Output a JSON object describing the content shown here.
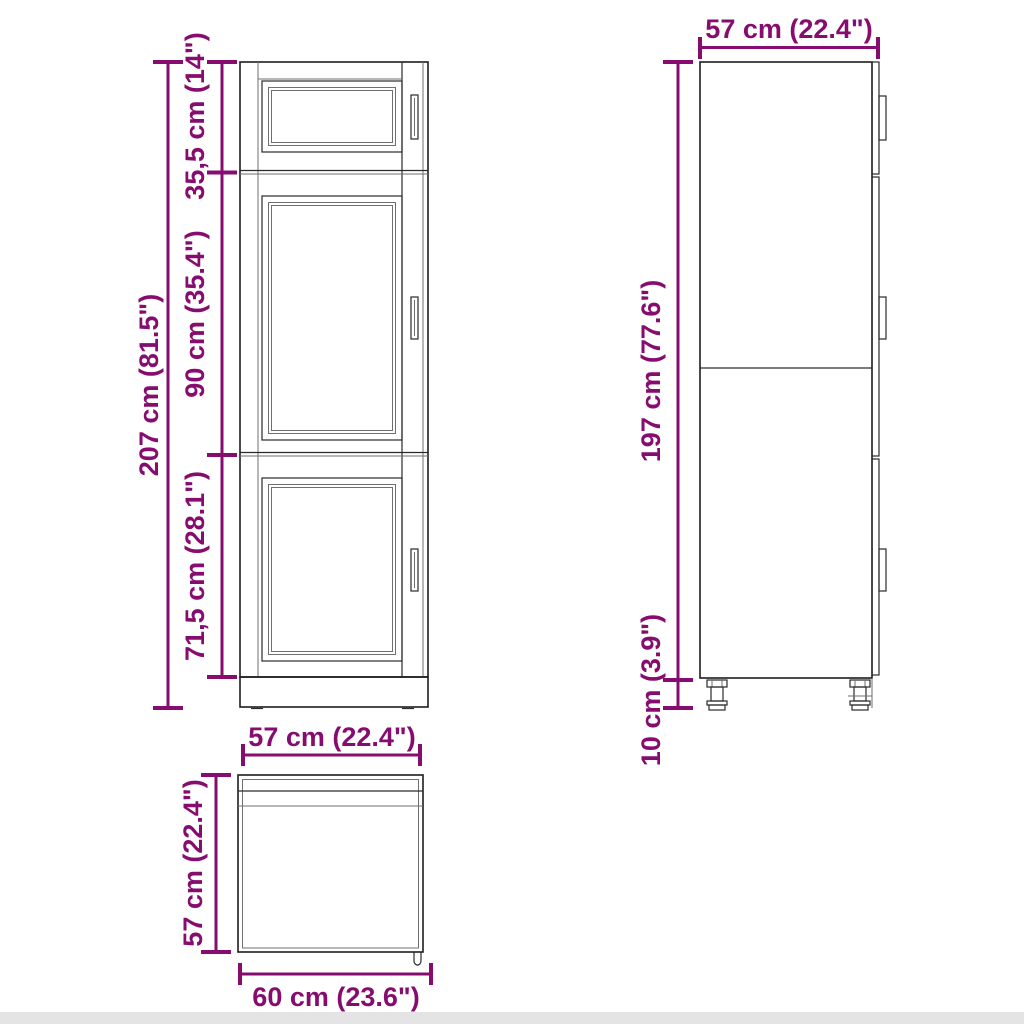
{
  "front": {
    "view_name": "front-elevation",
    "dim_total": "207 cm (81.5\")",
    "dim_top": "35,5 cm (14\")",
    "dim_mid": "90 cm (35.4\")",
    "dim_low": "71,5 cm (28.1\")"
  },
  "side": {
    "view_name": "side-elevation",
    "dim_width": "57 cm (22.4\")",
    "dim_height": "197 cm (77.6\")",
    "dim_legs": "10 cm (3.9\")"
  },
  "plan": {
    "view_name": "top-plan",
    "dim_width_top": "57 cm (22.4\")",
    "dim_depth": "57 cm (22.4\")",
    "dim_width_bottom": "60 cm (23.6\")"
  },
  "colors": {
    "dimension": "#860d6f",
    "outline_dark": "#1d1d1b",
    "outline_light": "#6f6f6f",
    "background": "#ffffff",
    "footer_strip": "#e4e4e4"
  }
}
